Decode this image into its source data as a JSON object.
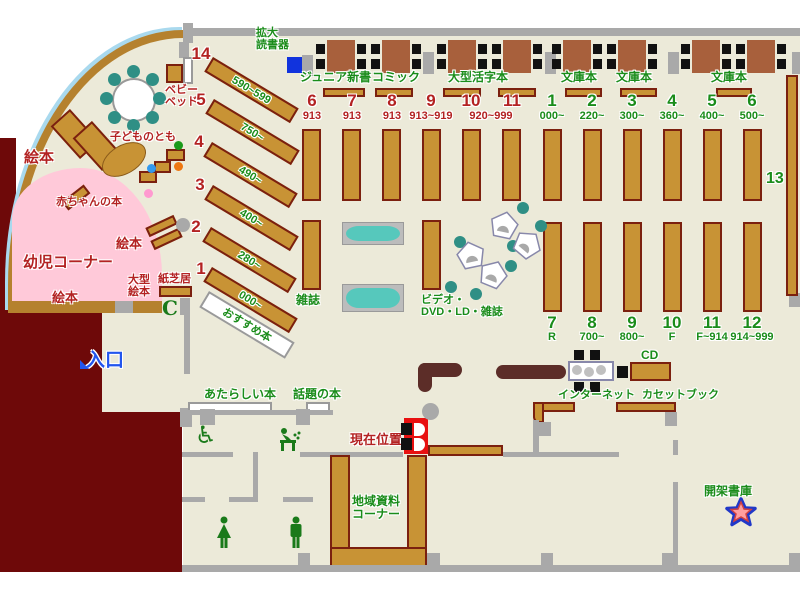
{
  "title": "library-floor-map",
  "colors": {
    "floor": "#ecead9",
    "wall": "#a9a9a9",
    "shelf": "#c89335",
    "shelf_border": "#7b200f",
    "maroon_area": "#6e0909",
    "pink_area": "#ffc9d9",
    "table": "#a8603c",
    "counter": "#5c2d28",
    "green_text": "#1a8c1a",
    "red_text": "#b32222",
    "blue_text": "#2255ee",
    "teal": "#2f8f85",
    "reader_device": "#1133dd",
    "marker_red": "#e81010"
  },
  "top_area": {
    "reader_label_1": "拡大",
    "reader_label_2": "読書器",
    "section_labels": [
      "ジュニア新書",
      "コミック",
      "大型活字本",
      "文庫本",
      "文庫本",
      "文庫本"
    ]
  },
  "sections": {
    "red_columns": [
      {
        "num": "6",
        "range": "913"
      },
      {
        "num": "7",
        "range": "913"
      },
      {
        "num": "8",
        "range": "913"
      },
      {
        "num": "9",
        "range": "913~919"
      },
      {
        "num": "10",
        "range": ""
      },
      {
        "num": "11",
        "range": ""
      }
    ],
    "red_shared_range": "920~999",
    "green_top_columns": [
      {
        "num": "1",
        "range": "000~"
      },
      {
        "num": "2",
        "range": "220~"
      },
      {
        "num": "3",
        "range": "300~"
      },
      {
        "num": "4",
        "range": "360~"
      },
      {
        "num": "5",
        "range": "400~"
      },
      {
        "num": "6",
        "range": "500~"
      }
    ],
    "green_bottom_columns": [
      {
        "num": "7",
        "range": "R"
      },
      {
        "num": "8",
        "range": "700~"
      },
      {
        "num": "9",
        "range": "800~"
      },
      {
        "num": "10",
        "range": "F"
      },
      {
        "num": "11",
        "range": "F~914"
      },
      {
        "num": "12",
        "range": "914~999"
      }
    ],
    "diagonal_shelves": [
      {
        "num": "14",
        "range": "590~599"
      },
      {
        "num": "5",
        "range": "750~"
      },
      {
        "num": "4",
        "range": "490~"
      },
      {
        "num": "3",
        "range": "400~"
      },
      {
        "num": "2",
        "range": "280~"
      },
      {
        "num": "1",
        "range": "000~"
      }
    ],
    "shelf_13_label": "13"
  },
  "children_area": {
    "corner_label": "幼児コーナー",
    "picture_books_left": "絵本",
    "picture_books_mid": "絵本",
    "picture_books_bottom": "絵本",
    "baby_books_label": "赤ちゃんの本",
    "kodomo_no_tomo_label": "子どものとも",
    "baby_bed_label_1": "ベビー",
    "baby_bed_label_2": "ベッド",
    "large_picture_book_1": "大型",
    "large_picture_book_2": "絵本",
    "kamishibai_label": "紙芝居",
    "phone_glyph": "C"
  },
  "center_area": {
    "magazines_label": "雑誌",
    "video_label_1": "ビデオ・",
    "video_label_2": "DVD・LD・雑誌",
    "recommended_label": "おすすめ本",
    "new_books_label": "あたらしい本",
    "topical_books_label": "話題の本"
  },
  "bottom_area": {
    "entrance_label": "入口",
    "current_location_label": "現在位置",
    "local_materials_label_1": "地域資料",
    "local_materials_label_2": "コーナー",
    "internet_label": "インターネット",
    "cd_label": "CD",
    "cassette_label": "カセットブック",
    "stacks_label": "開架書庫"
  }
}
